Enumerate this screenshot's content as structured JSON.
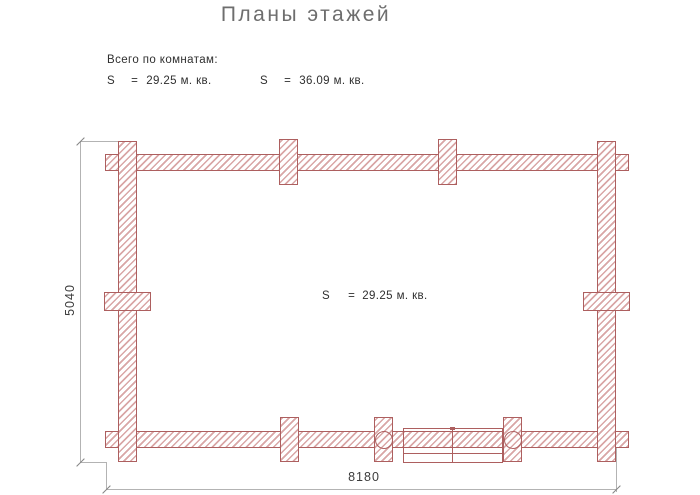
{
  "title": "Планы этажей",
  "summary": {
    "heading": "Всего по комнатам:",
    "rooms": [
      {
        "symbol": "S",
        "equals": "=",
        "value": "29.25 м. кв."
      },
      {
        "symbol": "S",
        "equals": "=",
        "value": "36.09 м. кв."
      }
    ]
  },
  "plan": {
    "room_label": {
      "symbol": "S",
      "equals": "=",
      "value": "29.25 м. кв."
    },
    "dimensions": {
      "width_mm": "8180",
      "height_mm": "5040"
    }
  },
  "colors": {
    "wall_outline": "#ad5f5f",
    "wall_hatch": "#d9a6a6",
    "dimension_line": "#b3b3b3",
    "dimension_text": "#3c3c3c",
    "title_text": "#6e6e6e",
    "body_text": "#2f2f2f",
    "background": "#ffffff"
  }
}
